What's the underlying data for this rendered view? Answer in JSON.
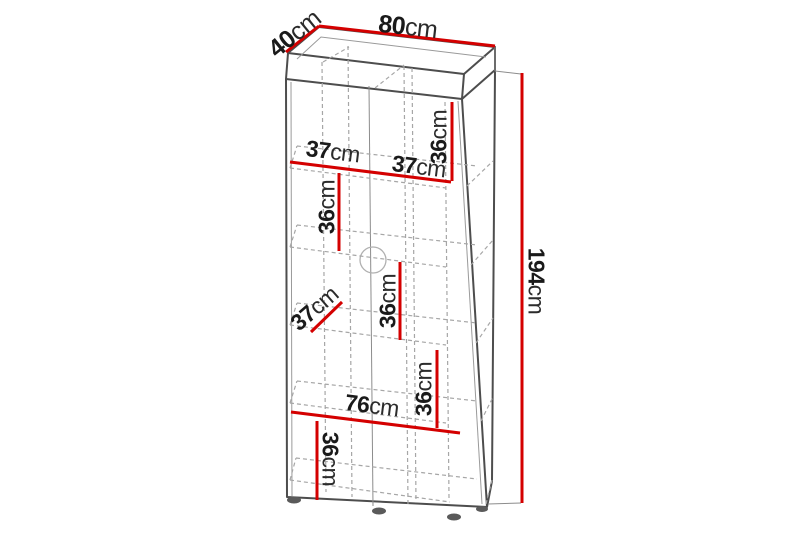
{
  "diagram": {
    "kind": "furniture-dimension-diagram",
    "object": "two-door tall cabinet wireframe",
    "unit": "cm",
    "colors": {
      "dimension_line": "#d40000",
      "outline": "#4d4d4d",
      "hidden_line": "#a6a6a6",
      "label_text": "#1a1a1a",
      "background": "#ffffff"
    },
    "dims": {
      "width": {
        "value": "80",
        "unit": "cm"
      },
      "depth": {
        "value": "40",
        "unit": "cm"
      },
      "height": {
        "value": "194",
        "unit": "cm"
      },
      "top_left_compartment_width": {
        "value": "37",
        "unit": "cm"
      },
      "top_right_compartment_width": {
        "value": "37",
        "unit": "cm"
      },
      "top_right_compartment_height": {
        "value": "36",
        "unit": "cm"
      },
      "upper_left_compartment_height": {
        "value": "36",
        "unit": "cm"
      },
      "middle_compartment_height": {
        "value": "36",
        "unit": "cm"
      },
      "middle_left_shelf_width": {
        "value": "37",
        "unit": "cm"
      },
      "lower_right_compartment_height": {
        "value": "36",
        "unit": "cm"
      },
      "interior_width": {
        "value": "76",
        "unit": "cm"
      },
      "bottom_left_compartment_height": {
        "value": "36",
        "unit": "cm"
      }
    }
  }
}
